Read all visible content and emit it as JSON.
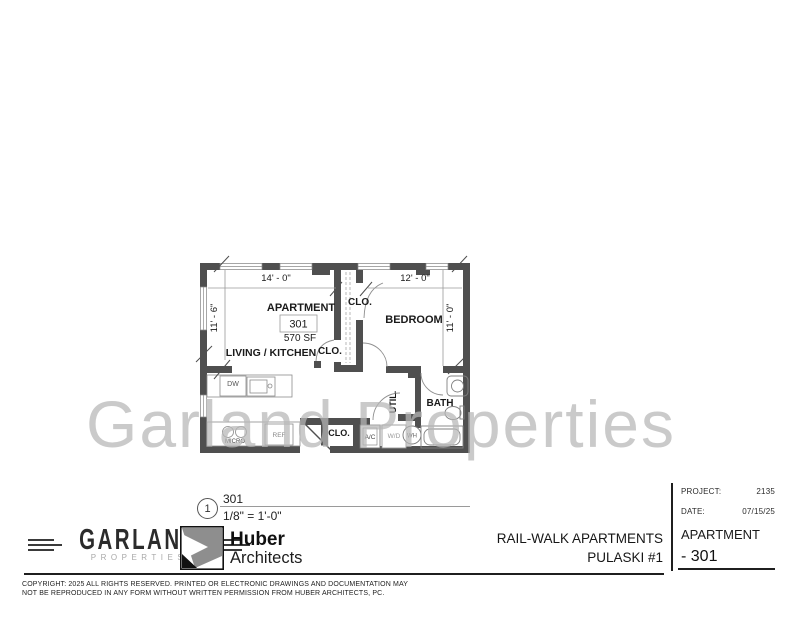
{
  "watermark": "Garland Properties",
  "plan": {
    "rooms": {
      "apartment_label": "APARTMENT",
      "unit_number": "301",
      "area": "570 SF",
      "living": "LIVING / KITCHEN",
      "bedroom": "BEDROOM",
      "bath": "BATH",
      "util": "UTIL.",
      "closet_top": "CLO.",
      "closet_mid": "CLO.",
      "closet_low": "CLO."
    },
    "fixtures": {
      "dw": "DW",
      "micro": "MICRO",
      "ref": "REF",
      "ac": "A/C",
      "wd": "W/D",
      "wh": "WH"
    },
    "dimensions": {
      "top_left": "14' - 0\"",
      "top_right": "12' - 0\"",
      "left": "11' - 6\"",
      "right": "11' - 0\""
    }
  },
  "scale_ref": {
    "marker": "1",
    "name": "301",
    "scale": "1/8\" = 1'-0\""
  },
  "footer": {
    "garland": {
      "name": "GARLAND",
      "sub": "PROPERTIES"
    },
    "huber": {
      "name": "Huber",
      "sub": "Architects"
    },
    "project_title_line1": "RAIL-WALK APARTMENTS",
    "project_title_line2": "PULASKI #1",
    "title_block": {
      "project_label": "PROJECT:",
      "project_value": "2135",
      "date_label": "DATE:",
      "date_value": "07/15/25",
      "sheet_label": "APARTMENT",
      "sheet_value": "- 301"
    },
    "copyright_line1": "COPYRIGHT: 2025 ALL RIGHTS RESERVED.  PRINTED OR ELECTRONIC DRAWINGS AND DOCUMENTATION MAY",
    "copyright_line2": "NOT BE REPRODUCED IN ANY FORM WITHOUT WRITTEN PERMISSION FROM HUBER ARCHITECTS, PC."
  },
  "colors": {
    "wall": "#4f4f4f",
    "watermark": "#b7b7b7",
    "line": "#1f1f1f"
  }
}
